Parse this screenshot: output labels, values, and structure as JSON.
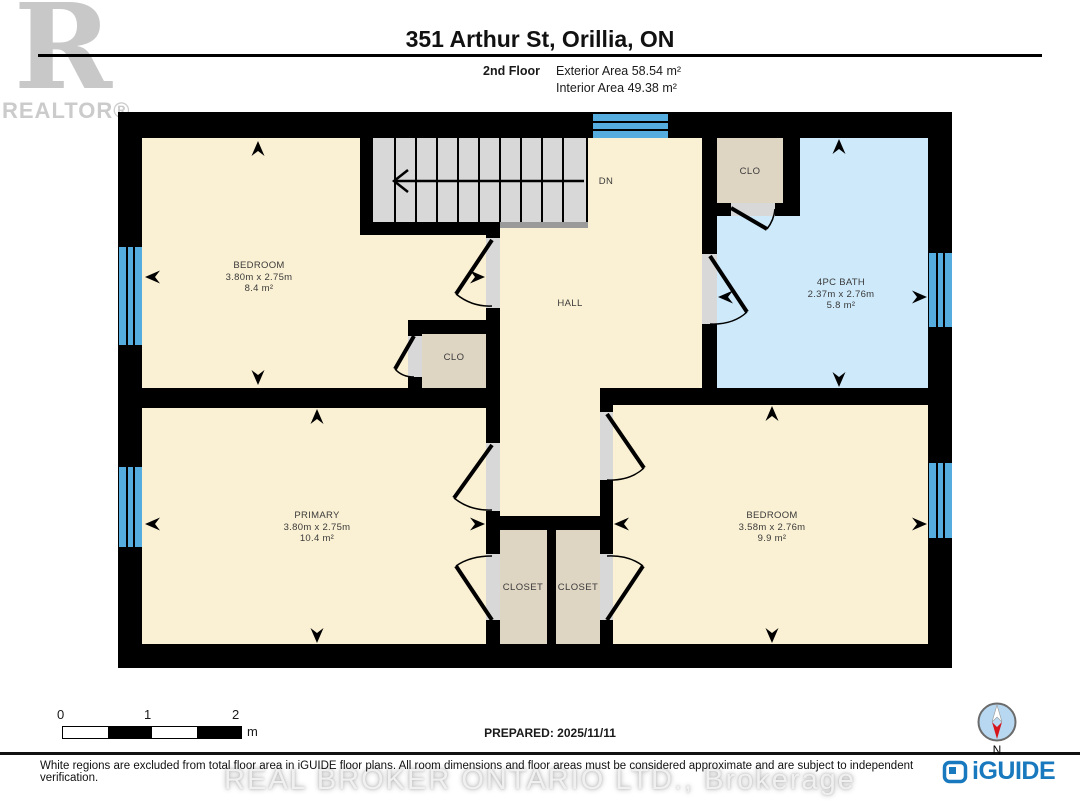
{
  "header": {
    "realtor_logo_letter": "R",
    "realtor_label": "REALTOR®",
    "title": "351 Arthur St, Orillia, ON",
    "floor_label": "2nd Floor",
    "exterior_area": "Exterior Area 58.54 m²",
    "interior_area": "Interior Area 49.38 m²"
  },
  "rooms": {
    "bedroom_top": {
      "name": "BEDROOM",
      "dims": "3.80m x 2.75m",
      "area": "8.4 m²"
    },
    "primary": {
      "name": "PRIMARY",
      "dims": "3.80m x 2.75m",
      "area": "10.4 m²"
    },
    "bedroom_right": {
      "name": "BEDROOM",
      "dims": "3.58m x 2.76m",
      "area": "9.9 m²"
    },
    "bath": {
      "name": "4PC BATH",
      "dims": "2.37m x 2.76m",
      "area": "5.8 m²"
    },
    "hall": {
      "name": "HALL"
    },
    "stairs": {
      "name": "DN"
    },
    "closet_mid": {
      "name": "CLO"
    },
    "closet_bath": {
      "name": "CLO"
    },
    "closet_left": {
      "name": "CLOSET"
    },
    "closet_right": {
      "name": "CLOSET"
    }
  },
  "scale_bar": {
    "tick_0": "0",
    "tick_1": "1",
    "tick_2": "2",
    "unit": "m"
  },
  "prepared_label": "PREPARED: 2025/11/11",
  "footer": {
    "disclaimer": "White regions are excluded from total floor area in iGUIDE floor plans. All room dimensions and floor areas must be considered approximate and are subject to independent verification.",
    "watermark": "REAL BROKER ONTARIO LTD., Brokerage",
    "brand": "iGUIDE",
    "compass_label": "N"
  },
  "colors": {
    "room_fill": "#FAF0D3",
    "bath_fill": "#CDE9FA",
    "closet_fill": "#DFD5C3",
    "window_blue": "#55ACDE",
    "wall": "#000000",
    "iguide_blue": "#1879BE"
  }
}
